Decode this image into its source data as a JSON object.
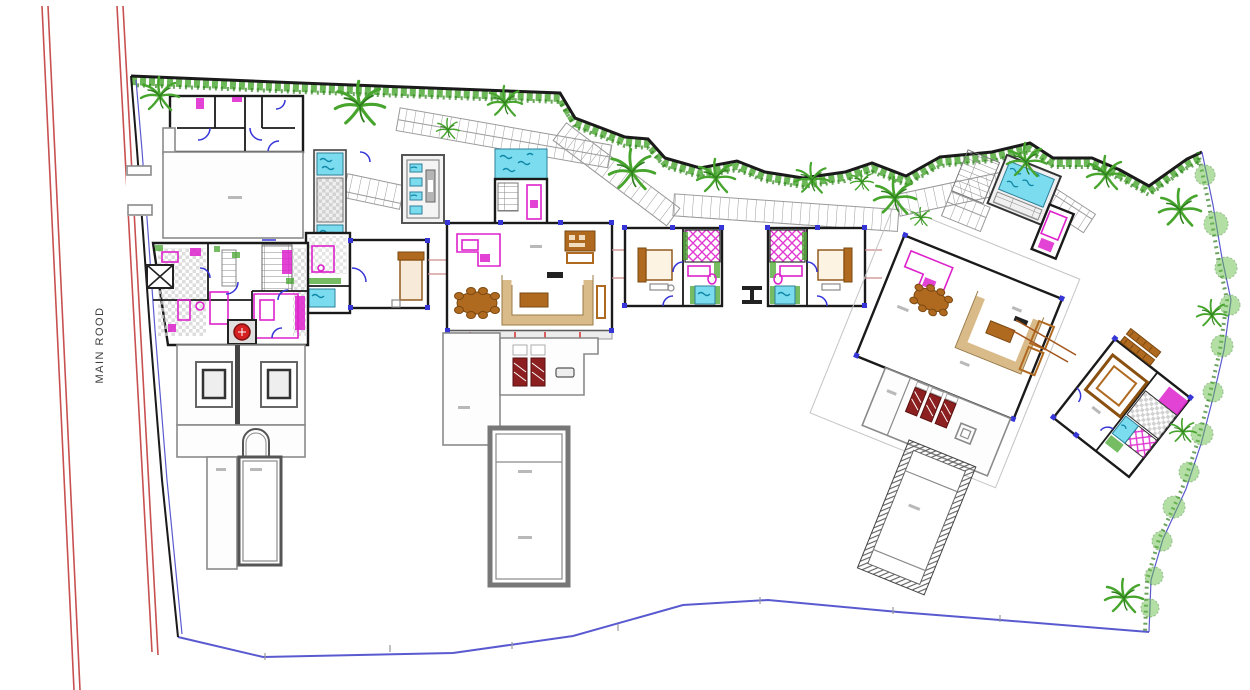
{
  "labels": {
    "road": "MAIN ROOD"
  },
  "colors": {
    "wall": "#1a1a1a",
    "gray-wall": "#8a8a8a",
    "fixture": "#dd22cc",
    "water": "#7adcee",
    "water-dark": "#1187a8",
    "veg": "#47a52e",
    "veg-dark": "#2e7d1d",
    "road": "#c85050",
    "bound": "#5a5ad0",
    "brown": "#b06a20",
    "tan": "#d9bb8a",
    "lounge": "#8c2020",
    "marker": "#3535d8",
    "accent-red": "#d42020"
  }
}
